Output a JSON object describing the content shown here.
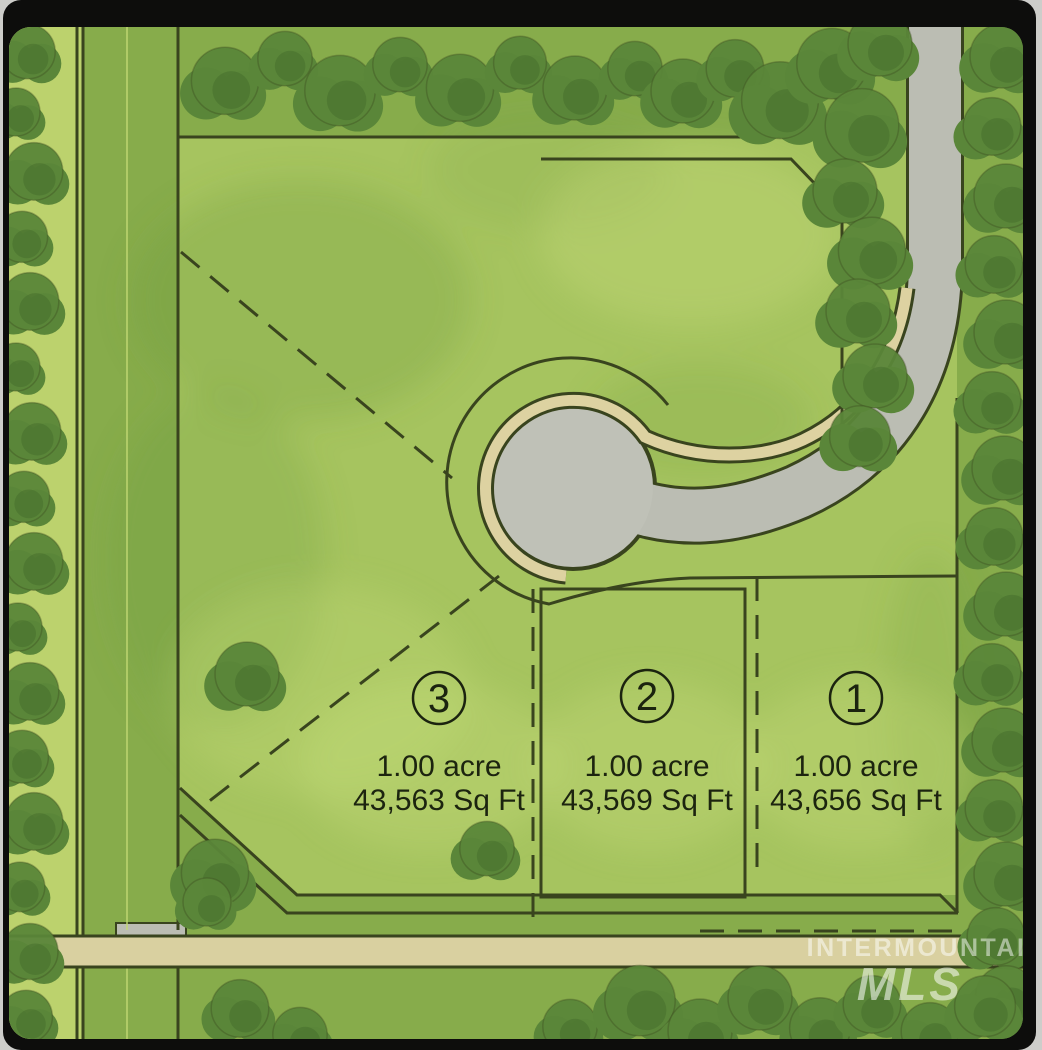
{
  "map": {
    "lots": [
      {
        "number": "3",
        "acreage": "1.00 acre",
        "sqft": "43,563 Sq Ft"
      },
      {
        "number": "2",
        "acreage": "1.00 acre",
        "sqft": "43,569 Sq Ft"
      },
      {
        "number": "1",
        "acreage": "1.00 acre",
        "sqft": "43,656 Sq Ft"
      }
    ],
    "watermark": {
      "brand": "INTERMOUNTAIN",
      "logo": "MLS"
    },
    "colors": {
      "grass_light": "#a6c45f",
      "grass_medium": "#87ac4b",
      "verge_light": "#bcd26d",
      "road_gray": "#bbbdb3",
      "culdesac_gray": "#bfc1b7",
      "sidewalk_tan": "#ddd2a1",
      "street_tan": "#d9d0a0",
      "tree_green": "#5a8639",
      "tree_shade": "#47702e",
      "line_dark": "#39441e",
      "frame_black": "#0d0d0c",
      "label_ink": "#1b230f",
      "watermark_white": "rgba(255,255,255,0.5)"
    },
    "trees": [
      [
        28,
        55,
        34
      ],
      [
        16,
        115,
        30
      ],
      [
        34,
        175,
        36
      ],
      [
        22,
        240,
        32
      ],
      [
        30,
        305,
        36
      ],
      [
        16,
        370,
        30
      ],
      [
        32,
        435,
        36
      ],
      [
        24,
        500,
        32
      ],
      [
        34,
        565,
        36
      ],
      [
        18,
        630,
        30
      ],
      [
        30,
        695,
        36
      ],
      [
        22,
        760,
        33
      ],
      [
        34,
        825,
        36
      ],
      [
        20,
        890,
        31
      ],
      [
        30,
        955,
        35
      ],
      [
        26,
        1020,
        33
      ],
      [
        225,
        85,
        42
      ],
      [
        285,
        62,
        34
      ],
      [
        340,
        95,
        44
      ],
      [
        400,
        68,
        34
      ],
      [
        460,
        92,
        42
      ],
      [
        520,
        66,
        33
      ],
      [
        575,
        92,
        40
      ],
      [
        635,
        72,
        34
      ],
      [
        683,
        95,
        40
      ],
      [
        735,
        72,
        36
      ],
      [
        780,
        105,
        48
      ],
      [
        832,
        68,
        44
      ],
      [
        880,
        48,
        40
      ],
      [
        862,
        130,
        46
      ],
      [
        845,
        195,
        40
      ],
      [
        872,
        255,
        42
      ],
      [
        858,
        315,
        40
      ],
      [
        875,
        380,
        40
      ],
      [
        860,
        440,
        38
      ],
      [
        1002,
        60,
        40
      ],
      [
        992,
        130,
        36
      ],
      [
        1006,
        200,
        40
      ],
      [
        994,
        268,
        36
      ],
      [
        1006,
        336,
        40
      ],
      [
        992,
        404,
        36
      ],
      [
        1004,
        472,
        40
      ],
      [
        994,
        540,
        36
      ],
      [
        1006,
        608,
        40
      ],
      [
        992,
        676,
        36
      ],
      [
        1004,
        744,
        40
      ],
      [
        994,
        812,
        36
      ],
      [
        1006,
        878,
        40
      ],
      [
        996,
        940,
        36
      ],
      [
        1006,
        1000,
        38
      ],
      [
        240,
        1012,
        36
      ],
      [
        300,
        1038,
        34
      ],
      [
        570,
        1030,
        34
      ],
      [
        640,
        1005,
        44
      ],
      [
        700,
        1035,
        40
      ],
      [
        760,
        1002,
        40
      ],
      [
        820,
        1032,
        38
      ],
      [
        872,
        1008,
        36
      ],
      [
        930,
        1035,
        36
      ],
      [
        985,
        1010,
        38
      ],
      [
        247,
        678,
        40
      ],
      [
        215,
        877,
        42
      ],
      [
        487,
        852,
        34
      ],
      [
        207,
        905,
        30
      ]
    ]
  }
}
